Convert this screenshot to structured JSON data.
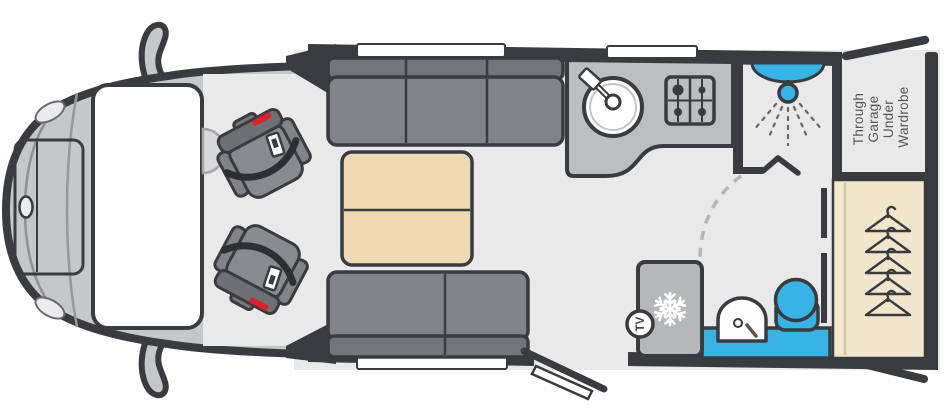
{
  "diagram": {
    "type": "motorhome-floorplan-top-view",
    "labels": {
      "garage_line1": "Through",
      "garage_line2": "Garage",
      "garage_line3": "Under",
      "garage_line4": "Wardrobe",
      "tv": "TV"
    },
    "colors": {
      "outline_wall": "#3a3b3f",
      "floor": "#e9e9ea",
      "cab_body": "#c6c7c9",
      "sofa_seat": "#828387",
      "sofa_back": "#747579",
      "table_beige": "#eed9b2",
      "wardrobe_beige": "#f2e7cd",
      "worktop_gray": "#bdbec0",
      "fridge_gray": "#b6b7b9",
      "water_blue": "#38b3e5",
      "seatbelt_red": "#d8232a",
      "window_white": "#ffffff",
      "label_gray": "#55565a"
    },
    "features": [
      "cab-swivel-seats",
      "lounge-sofas",
      "pedestal-table",
      "kitchen-sink",
      "hob",
      "fridge",
      "tv-point",
      "shower-cubicle",
      "washbasin",
      "toilet",
      "wardrobe-hanging",
      "through-garage",
      "entry-door",
      "windows"
    ]
  }
}
